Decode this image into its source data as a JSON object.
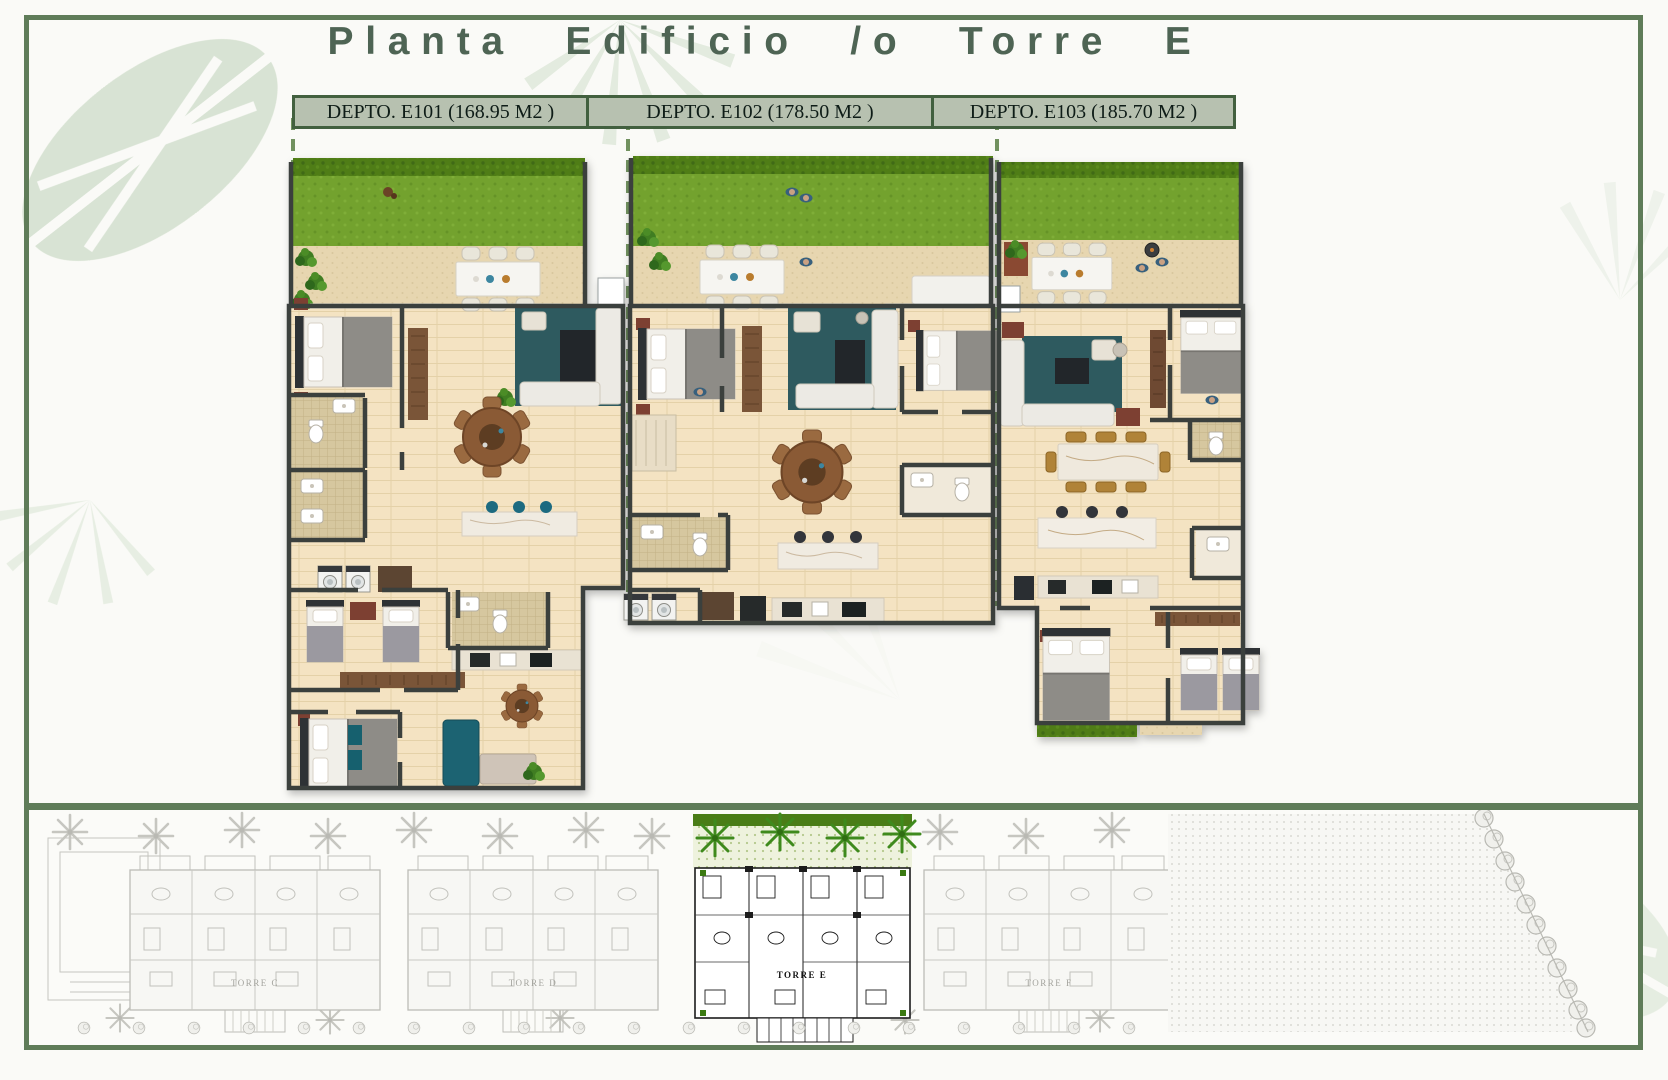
{
  "page": {
    "title": "Planta Edificio /o Torre E"
  },
  "apartments": [
    {
      "id": "E101",
      "label": "DEPTO. E101 (168.95 M2 )",
      "area_m2": "168.95"
    },
    {
      "id": "E102",
      "label": "DEPTO. E102 (178.50 M2 )",
      "area_m2": "178.50"
    },
    {
      "id": "E103",
      "label": "DEPTO. E103 (185.70 M2 )",
      "area_m2": "185.70"
    }
  ],
  "site_plan": {
    "towers": [
      {
        "name": "TORRE C",
        "highlighted": false
      },
      {
        "name": "TORRE D",
        "highlighted": false
      },
      {
        "name": "TORRE E",
        "highlighted": true
      },
      {
        "name": "TORRE F",
        "highlighted": false
      }
    ]
  },
  "colors": {
    "frame_green": "#5f7c59",
    "header_fill": "#b7c1b0",
    "header_border": "#42603f",
    "title_green": "#4e6454",
    "grass": "#73a22f",
    "hedge": "#4f7d19",
    "terrace": "#e7d6b0",
    "floor": "#f4e3c2",
    "wall": "#3b3f3e",
    "rug_teal": "#2d5a5f",
    "wood": "#8a5a36",
    "marble": "#f0ebe1",
    "highlight_palm": "#3f8a1d"
  }
}
